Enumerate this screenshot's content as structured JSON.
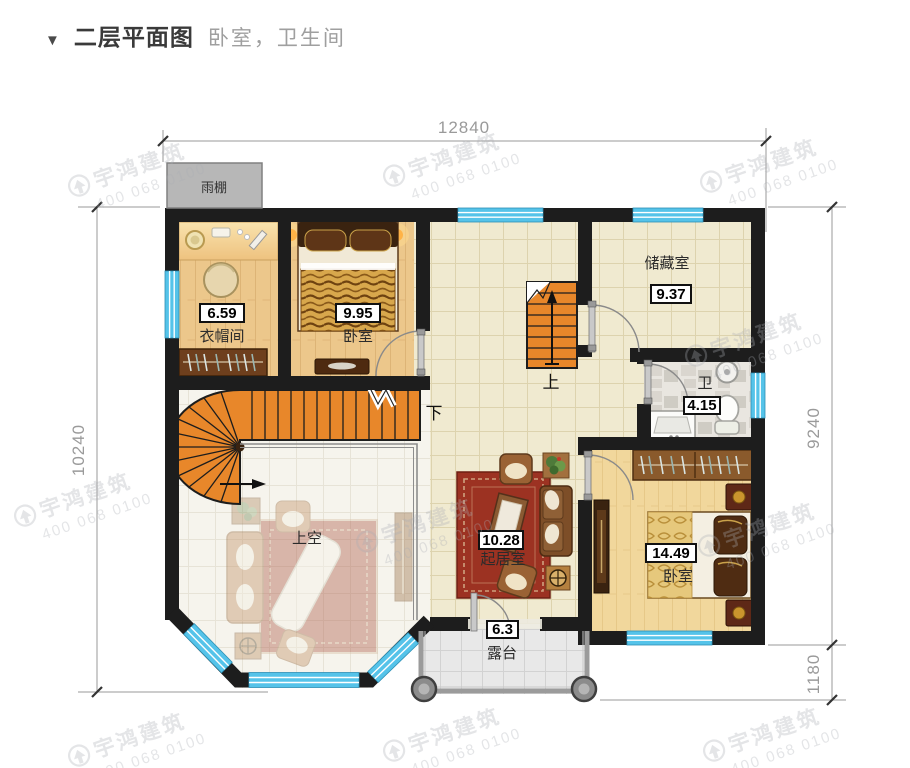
{
  "page": {
    "marker": "▼",
    "title": "二层平面图",
    "subtitle": "卧室，卫生间"
  },
  "watermark": {
    "brand": "宇鸿建筑",
    "phone": "400 068 0100"
  },
  "dims": {
    "top": "12840",
    "left": "10240",
    "right": "9240",
    "right_lower": "1180"
  },
  "canopy": {
    "label": "雨棚"
  },
  "stairs": {
    "up": "上",
    "down": "下"
  },
  "rooms": {
    "cloakroom": {
      "name": "衣帽间",
      "area": "6.59"
    },
    "bedroom1": {
      "name": "卧室",
      "area": "9.95"
    },
    "storage": {
      "name": "储藏室",
      "area": "9.37"
    },
    "bathroom": {
      "name": "卫",
      "area": "4.15"
    },
    "living": {
      "name": "起居室",
      "area": "10.28"
    },
    "bedroom2": {
      "name": "卧室",
      "area": "14.49"
    },
    "void": {
      "name": "上空"
    },
    "terrace": {
      "name": "露台",
      "area": "6.3"
    }
  },
  "colors": {
    "wall": "#1d1d1d",
    "window": "#55c3e9",
    "stair": "#e8872a",
    "wood": "#ecc78b",
    "tile": "#f0ead0",
    "carpet": "#9c3222"
  }
}
